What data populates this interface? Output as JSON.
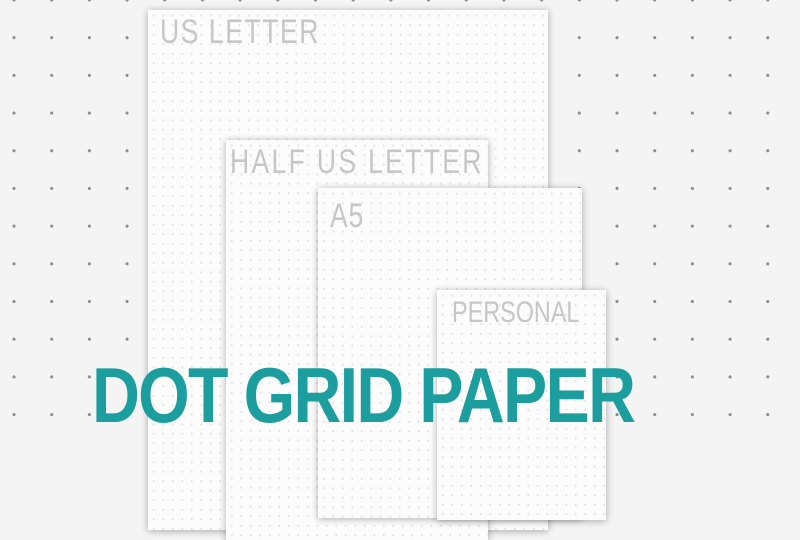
{
  "title": {
    "text": "DOT GRID PAPER",
    "color": "#1c9d9e"
  },
  "sheets": [
    {
      "label": "US LETTER"
    },
    {
      "label": "HALF US LETTER"
    },
    {
      "label": "A5"
    },
    {
      "label": "PERSONAL"
    }
  ],
  "colors": {
    "page_background": "#f4f4f4",
    "background_dot": "#8d8d8d",
    "paper": "#fcfcfc",
    "paper_dot": "#e3e3e3",
    "sheet_label": "#c6c6c6",
    "accent_teal": "#1c9d9e"
  }
}
